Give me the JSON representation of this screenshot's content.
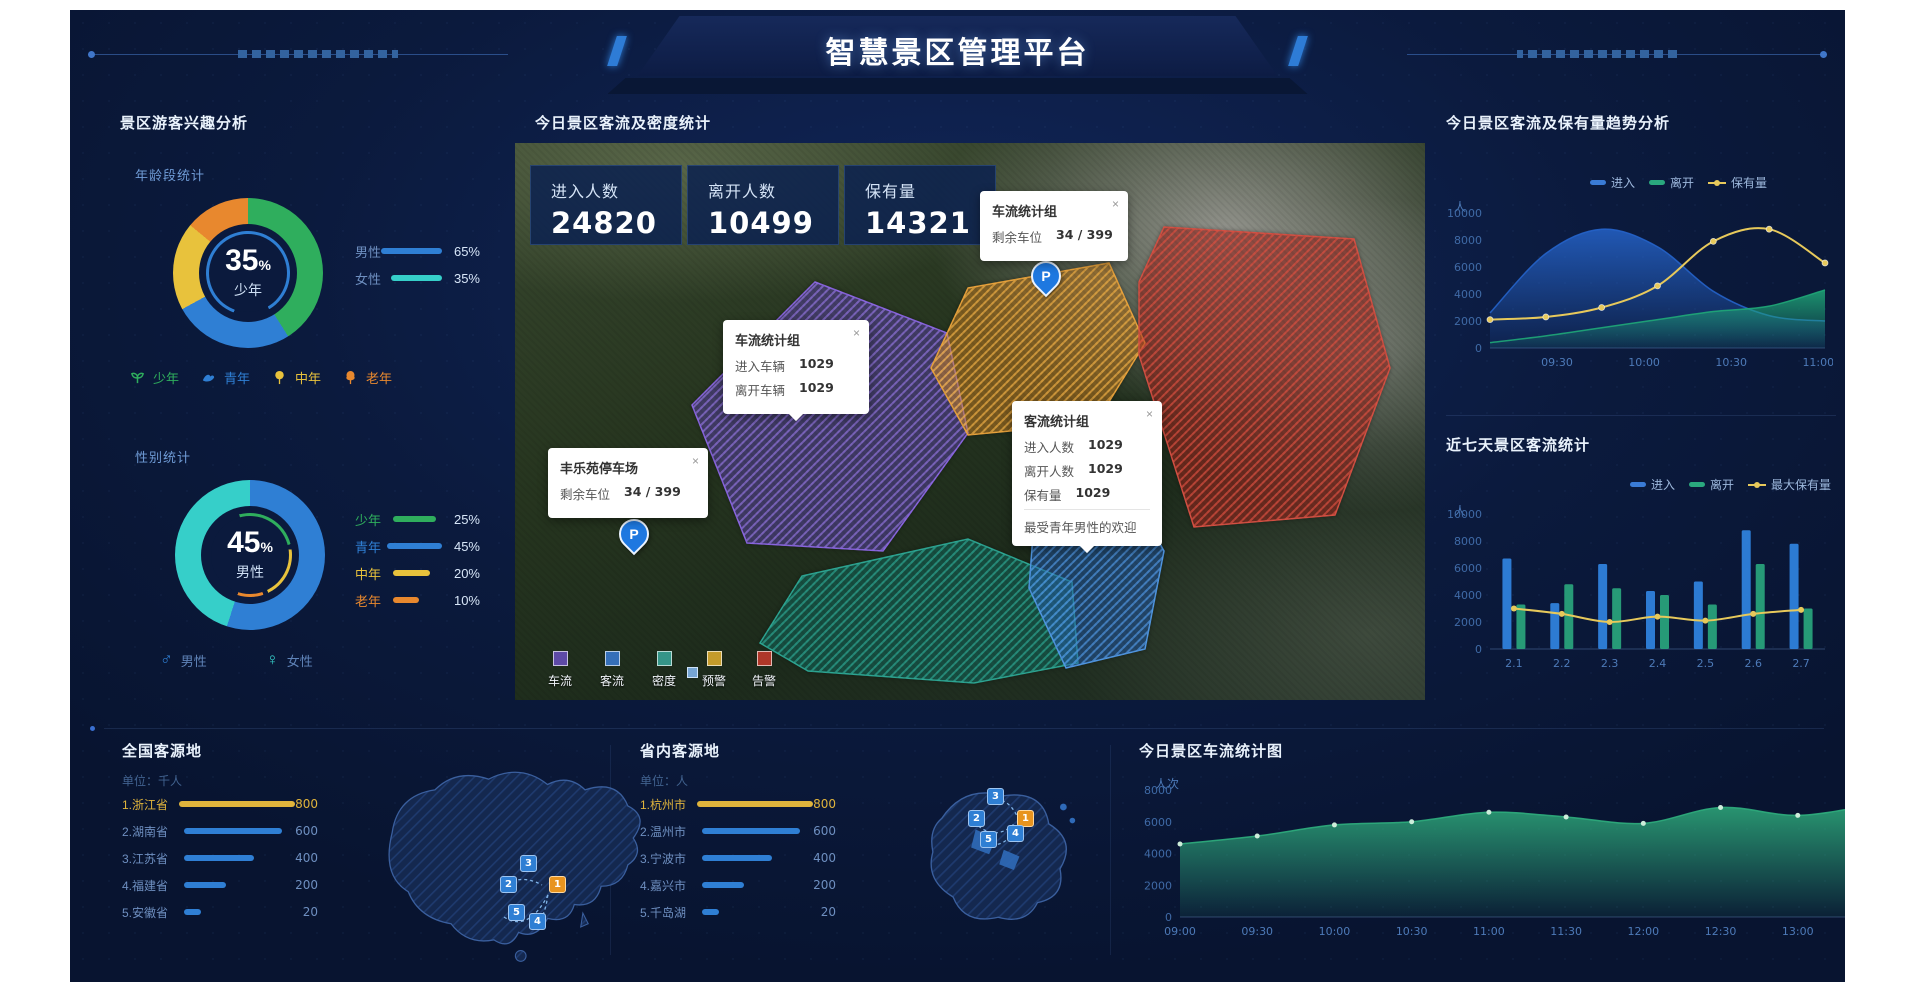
{
  "ui": {
    "close_glyph": "×"
  },
  "header": {
    "title": "智慧景区管理平台"
  },
  "left_panel": {
    "title": "景区游客兴趣分析",
    "age_section": {
      "subtitle": "年龄段统计",
      "center_value": "35",
      "center_unit": "%",
      "center_label": "少年",
      "legend": [
        {
          "label": "男性",
          "value": "65%",
          "pct": 65
        },
        {
          "label": "女性",
          "value": "35%",
          "pct": 35
        }
      ],
      "icons": [
        {
          "label": "少年"
        },
        {
          "label": "青年"
        },
        {
          "label": "中年"
        },
        {
          "label": "老年"
        }
      ]
    },
    "gender_section": {
      "subtitle": "性别统计",
      "center_value": "45",
      "center_unit": "%",
      "center_label": "男性",
      "legend": [
        {
          "label": "少年",
          "value": "25%",
          "pct": 25
        },
        {
          "label": "青年",
          "value": "45%",
          "pct": 45
        },
        {
          "label": "中年",
          "value": "20%",
          "pct": 20
        },
        {
          "label": "老年",
          "value": "10%",
          "pct": 10
        }
      ],
      "icons": [
        {
          "label": "男性"
        },
        {
          "label": "女性"
        }
      ]
    }
  },
  "map_panel": {
    "title": "今日景区客流及密度统计",
    "stats": [
      {
        "label": "进入人数",
        "value": "24820"
      },
      {
        "label": "离开人数",
        "value": "10499"
      },
      {
        "label": "保有量",
        "value": "14321"
      }
    ],
    "popup_parking_group": {
      "title": "车流统计组",
      "row_label": "剩余车位",
      "row_value": "34 / 399"
    },
    "popup_vehicle": {
      "title": "车流统计组",
      "rows": [
        {
          "label": "进入车辆",
          "value": "1029"
        },
        {
          "label": "离开车辆",
          "value": "1029"
        }
      ]
    },
    "popup_visitor": {
      "title": "客流统计组",
      "rows": [
        {
          "label": "进入人数",
          "value": "1029"
        },
        {
          "label": "离开人数",
          "value": "1029"
        },
        {
          "label": "保有量",
          "value": "1029"
        }
      ],
      "footer": "最受青年男性的欢迎"
    },
    "popup_fengle": {
      "title": "丰乐苑停车场",
      "row_label": "剩余车位",
      "row_value": "34 / 399"
    },
    "marker_label": "P",
    "legend": [
      {
        "label": "车流",
        "color": "#6a4fc0"
      },
      {
        "label": "客流",
        "color": "#3a7bd5"
      },
      {
        "label": "密度",
        "color": "#3aa89b"
      },
      {
        "label": "预警",
        "color": "#d6a72e"
      },
      {
        "label": "告警",
        "color": "#c0392b"
      }
    ]
  },
  "right_panel": {
    "trend": {
      "title": "今日景区客流及保有量趋势分析",
      "unit": "人",
      "legend": [
        "进入",
        "离开",
        "保有量"
      ]
    },
    "week": {
      "title": "近七天景区客流统计",
      "unit": "人",
      "legend": [
        "进入",
        "离开",
        "最大保有量"
      ]
    }
  },
  "bottom": {
    "badges": [
      "1",
      "2",
      "3",
      "4",
      "5"
    ],
    "national": {
      "title": "全国客源地",
      "unit": "单位：千人",
      "rows": [
        {
          "name": "1.浙江省",
          "value": "800"
        },
        {
          "name": "2.湖南省",
          "value": "600"
        },
        {
          "name": "3.江苏省",
          "value": "400"
        },
        {
          "name": "4.福建省",
          "value": "200"
        },
        {
          "name": "5.安徽省",
          "value": "20"
        }
      ]
    },
    "province": {
      "title": "省内客源地",
      "unit": "单位：人",
      "rows": [
        {
          "name": "1.杭州市",
          "value": "800"
        },
        {
          "name": "2.温州市",
          "value": "600"
        },
        {
          "name": "3.宁波市",
          "value": "400"
        },
        {
          "name": "4.嘉兴市",
          "value": "200"
        },
        {
          "name": "5.千岛湖",
          "value": "20"
        }
      ]
    },
    "traffic": {
      "title": "今日景区车流统计图",
      "unit": "人次"
    }
  },
  "chart_data": [
    {
      "el": "trend-svg",
      "type": "area",
      "title": "今日景区客流及保有量趋势分析",
      "ylabel": "人",
      "ylim": [
        0,
        10000
      ],
      "yticks": [
        0,
        2000,
        4000,
        6000,
        8000,
        10000
      ],
      "x_labels": [
        "09:30",
        "10:00",
        "10:30",
        "11:00"
      ],
      "xlab_pos": [
        0.2,
        0.46,
        0.72,
        0.98
      ],
      "padL": 52,
      "padR": 8,
      "padT": 18,
      "padB": 22,
      "series": [
        {
          "name": "进入",
          "kind": "area",
          "color": "#2563c9",
          "values": [
            2600,
            7000,
            8800,
            7500,
            4200,
            2400,
            2000
          ]
        },
        {
          "name": "离开",
          "kind": "area",
          "color": "#1fa878",
          "values": [
            400,
            900,
            1500,
            2100,
            2700,
            3100,
            4300
          ]
        },
        {
          "name": "保有量",
          "kind": "line",
          "color": "#e7c95b",
          "values": [
            2100,
            2300,
            3000,
            4600,
            7900,
            8800,
            6300
          ]
        }
      ]
    },
    {
      "el": "week-svg",
      "type": "bar",
      "title": "近七天景区客流统计",
      "ylabel": "人",
      "ylim": [
        0,
        10000
      ],
      "yticks": [
        0,
        2000,
        4000,
        6000,
        8000,
        10000
      ],
      "categories": [
        "2.1",
        "2.2",
        "2.3",
        "2.4",
        "2.5",
        "2.6",
        "2.7"
      ],
      "padL": 52,
      "padR": 8,
      "padT": 16,
      "padB": 39,
      "series": [
        {
          "name": "进入",
          "kind": "bar",
          "color": "#3186e4",
          "values": [
            6700,
            3400,
            6300,
            4300,
            5000,
            8800,
            7800
          ]
        },
        {
          "name": "离开",
          "kind": "bar",
          "color": "#2aa87e",
          "values": [
            3300,
            4800,
            4500,
            4000,
            3300,
            6300,
            3000
          ]
        },
        {
          "name": "最大保有量",
          "kind": "line",
          "color": "#e7c95b",
          "values": [
            3000,
            2600,
            2000,
            2400,
            2100,
            2600,
            2900
          ]
        }
      ]
    },
    {
      "el": "traffic-svg",
      "type": "area",
      "title": "今日景区车流统计图",
      "ylabel": "人次",
      "ylim": [
        0,
        8000
      ],
      "yticks": [
        0,
        2000,
        4000,
        6000,
        8000
      ],
      "x_labels": [
        "09:00",
        "09:30",
        "10:00",
        "10:30",
        "11:00",
        "11:30",
        "12:00",
        "12:30",
        "13:00",
        "13:30"
      ],
      "padL": 55,
      "padR": 10,
      "padT": 25,
      "padB": 33,
      "series": [
        {
          "name": "车流",
          "kind": "area",
          "dots": true,
          "color": "#2fae7d",
          "values": [
            4600,
            5100,
            5800,
            6000,
            6600,
            6300,
            5900,
            6900,
            6400,
            7100
          ]
        }
      ]
    },
    {
      "el": "age-ring",
      "type": "pie",
      "title": "年龄段统计",
      "center_text": "35% 少年",
      "segments": [
        {
          "label": "少年",
          "value": 41,
          "color": "#2fae5d"
        },
        {
          "label": "青年",
          "value": 26,
          "color": "#2f7fd4"
        },
        {
          "label": "中年",
          "value": 19,
          "color": "#e8c23c"
        },
        {
          "label": "老年",
          "value": 14,
          "color": "#e8882e"
        }
      ]
    },
    {
      "el": "gender-ring",
      "type": "pie",
      "title": "性别统计",
      "center_text": "45% 男性",
      "segments": [
        {
          "label": "男性",
          "value": 55,
          "color": "#2f7fd4"
        },
        {
          "label": "女性",
          "value": 45,
          "color": "#36cfc9"
        }
      ]
    }
  ]
}
